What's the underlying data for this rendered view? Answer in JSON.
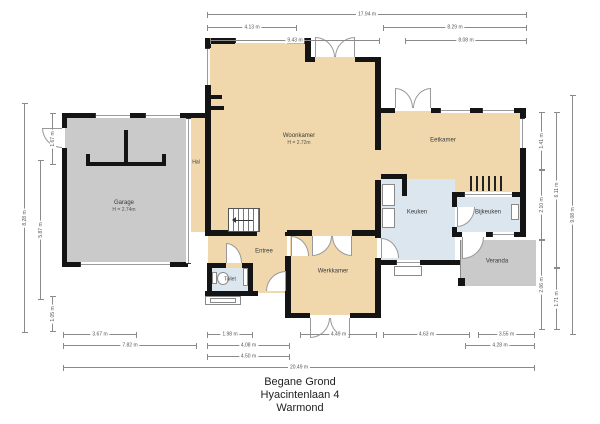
{
  "title": {
    "line1": "Begane Grond",
    "line2": "Hyacintenlaan 4",
    "line3": "Warmond"
  },
  "rooms": {
    "garage": {
      "name": "Garage",
      "height": "H = 2.74m"
    },
    "hal": {
      "name": "Hal"
    },
    "woonkamer": {
      "name": "Woonkamer",
      "height": "H = 2.72m"
    },
    "eetkamer": {
      "name": "Eetkamer"
    },
    "keuken": {
      "name": "Keuken"
    },
    "bijkeuken": {
      "name": "Bijkeuken"
    },
    "veranda": {
      "name": "Veranda"
    },
    "werkkamer": {
      "name": "Werkkamer"
    },
    "entree": {
      "name": "Entree"
    },
    "toilet": {
      "name": "Toilet"
    }
  },
  "dimensions": {
    "top": [
      "17.94 m",
      "4.13 m",
      "8.29 m",
      "9.43 m",
      "8.08 m"
    ],
    "bottom": [
      "3.67 m",
      "1.98 m",
      "4.49 m",
      "4.63 m",
      "3.55 m",
      "7.82 m",
      "4.08 m",
      "4.28 m",
      "4.50 m",
      "20.49 m"
    ],
    "left": [
      "8.28 m",
      "1.67 m",
      "5.87 m",
      "1.05 m"
    ],
    "right": [
      "1.41 m",
      "2.10 m",
      "2.06 m",
      "6.11 m",
      "1.71 m",
      "9.08 m"
    ]
  },
  "colors": {
    "wall": "#141414",
    "room_tan": "#f0d8ac",
    "room_blue": "#dce6ee",
    "room_gray": "#cacaca",
    "dimension": "#8a8a8a"
  }
}
